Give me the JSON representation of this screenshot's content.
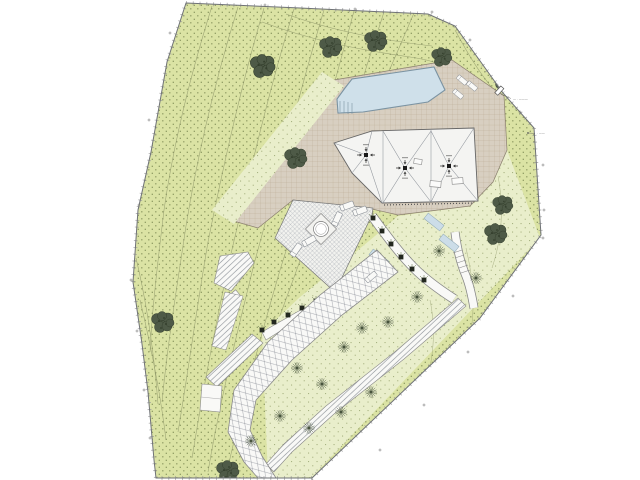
{
  "drawing": {
    "kind_label": "landscape site plan",
    "annotations": {
      "upper": {
        "text": "— · ———"
      },
      "lower": {
        "text": "· ——"
      }
    }
  },
  "colors": {
    "background": "#ffffff",
    "lawn": "#dbe3a4",
    "lawn_dot": "#6e7c45",
    "pale_green": "#e9eecb",
    "pale_dot": "#7d8c52",
    "beige": "#d8cfc1",
    "tile_line": "#b6a68e",
    "roof": "#f4f4f2",
    "roof_line": "#8f949b",
    "pool": "#cfe0ea",
    "pool_edge": "#7b93a2",
    "terrace": "#f2f2ef",
    "hatch_line": "#a9aeb6",
    "path": "#f9f9f7",
    "path_line": "#8a8f96",
    "tree": "#4e5a47",
    "tree_dark": "#343f2d",
    "shrub": "#44503a",
    "planter": "#23281f",
    "boundary": "#6f7276",
    "contour": "#8e9668",
    "text": "#3a3a3a",
    "drain": "#1a1a1a",
    "water_strip": "#ccdde8"
  }
}
